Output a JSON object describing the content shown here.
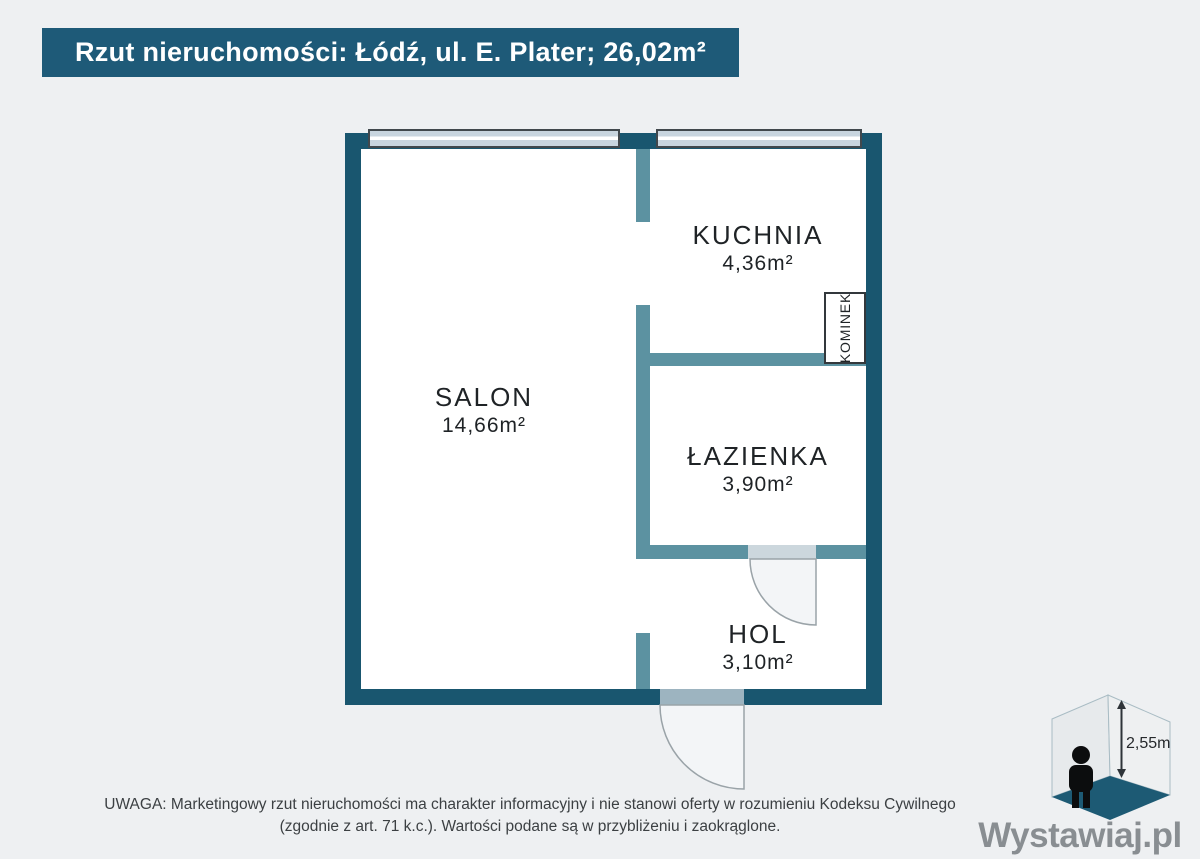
{
  "header": {
    "title": "Rzut nieruchomości: Łódź, ul. E. Plater; 26,02m²"
  },
  "floorplan": {
    "rooms": [
      {
        "name": "SALON",
        "area": "14,66m²"
      },
      {
        "name": "KUCHNIA",
        "area": "4,36m²"
      },
      {
        "name": "ŁAZIENKA",
        "area": "3,90m²"
      },
      {
        "name": "HOL",
        "area": "3,10m²"
      }
    ],
    "fixtures": [
      {
        "label": "KOMINEK"
      }
    ]
  },
  "footer": {
    "disclaimer_line1": "UWAGA: Marketingowy rzut nieruchomości ma charakter informacyjny i nie stanowi oferty w rozumieniu Kodeksu Cywilnego",
    "disclaimer_line2": "(zgodnie z art. 71 k.c.). Wartości podane są w przybliżeniu i zaokrąglone."
  },
  "branding": {
    "logo_text": "Wystawiaj.pl",
    "ceiling_height": "2,55m"
  },
  "colors": {
    "title_bg": "#1E5A78",
    "wall_outer": "#19566F",
    "wall_inner": "#5C92A1",
    "window_fill": "#C8D5DF",
    "floor_accent": "#1D5A74",
    "page_bg": "#EEF0F2",
    "logo_text_gray": "#898E92"
  }
}
